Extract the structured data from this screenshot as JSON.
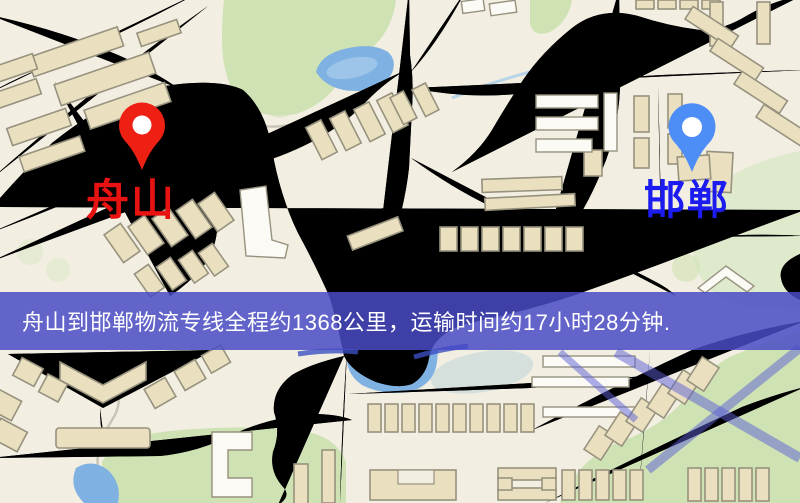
{
  "banner": {
    "text": "舟山到邯郸物流专线全程约1368公里，运输时间约17小时28分钟."
  },
  "route": {
    "origin": "舟山",
    "destination": "邯郸",
    "distance": "约1368公里",
    "duration": "约17小时28分钟"
  },
  "markers": {
    "origin": {
      "label": "舟山",
      "pin": "red-map-pin"
    },
    "destination": {
      "label": "邯郸",
      "pin": "blue-map-pin"
    }
  },
  "map": {
    "colors": {
      "bg": "#f2eee2",
      "road": "#f6d78b",
      "road_casing": "#e8c46c",
      "green": "#cfe2b4",
      "green_pale": "#dfeacd",
      "water": "#7fb2e2",
      "water_light": "#b5d6ef",
      "teal": "#a9cbd8",
      "rail": "#3f3f3f",
      "rail_dash": "#ffffff",
      "stream": "#c9c5b8",
      "stream_blue": "#b8d4e8",
      "bldg": "#eae0c0",
      "bldg_stroke": "#97927e",
      "bldg_white": "#fbfaf5",
      "route_overlay": "rgba(92,94,214,0.5)",
      "route_dark": "#3b4fc0",
      "banner_bg": "rgba(73,75,197,0.85)",
      "banner_text": "#ffffff",
      "origin_label": "#e81210",
      "dest_label": "#1c1cf0",
      "pin_origin": "#ee2014",
      "pin_dest": "#4d8df6"
    }
  }
}
